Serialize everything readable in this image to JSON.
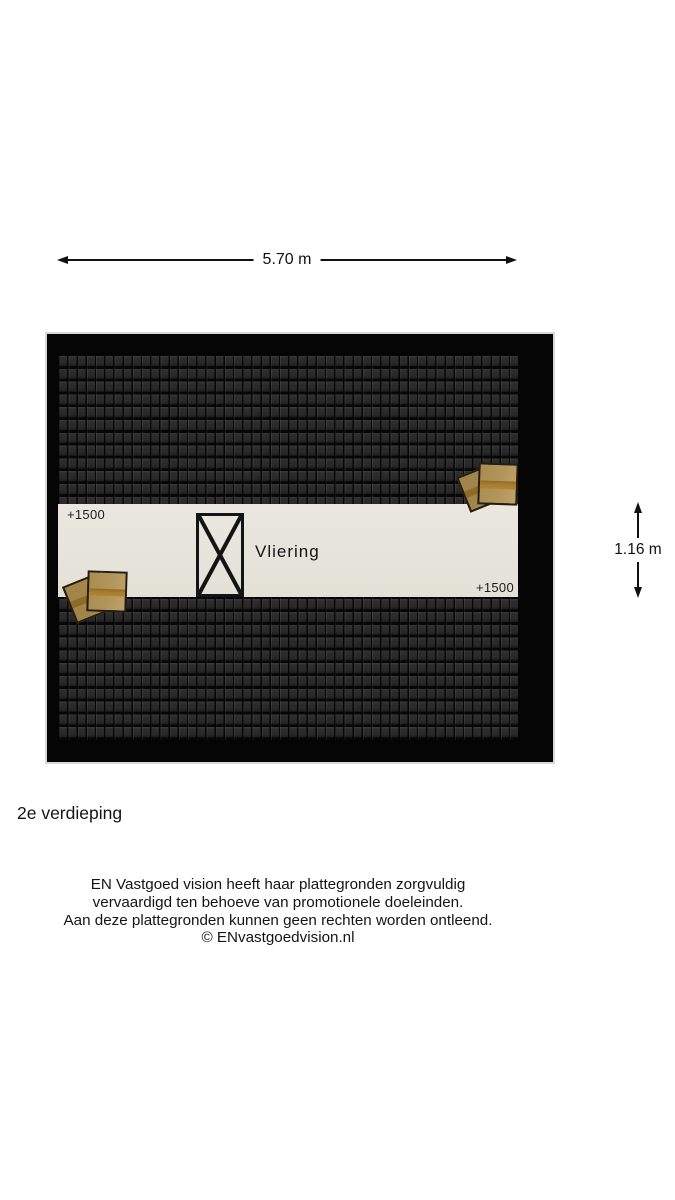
{
  "dimensions": {
    "width": {
      "label": "5.70 m"
    },
    "height": {
      "label": "1.16 m"
    }
  },
  "plan": {
    "room_label": "Vliering",
    "level_marker_top_left": "+1500",
    "level_marker_bottom_right": "+1500"
  },
  "floor_title": "2e verdieping",
  "footer": {
    "lines": [
      "EN Vastgoed vision heeft haar plattegronden zorgvuldig",
      "vervaardigd ten behoeve van promotionele doeleinden.",
      "Aan deze plattegronden kunnen geen rechten worden ontleend.",
      "© ENvastgoedvision.nl"
    ]
  },
  "colors": {
    "page_background": "#ffffff",
    "frame_black": "#050505",
    "roof_tile_dark": "#282828",
    "floor_strip": "#e7e4db",
    "box_wood": "#b2955b",
    "box_band": "#a87d2f",
    "line_black": "#111111"
  }
}
